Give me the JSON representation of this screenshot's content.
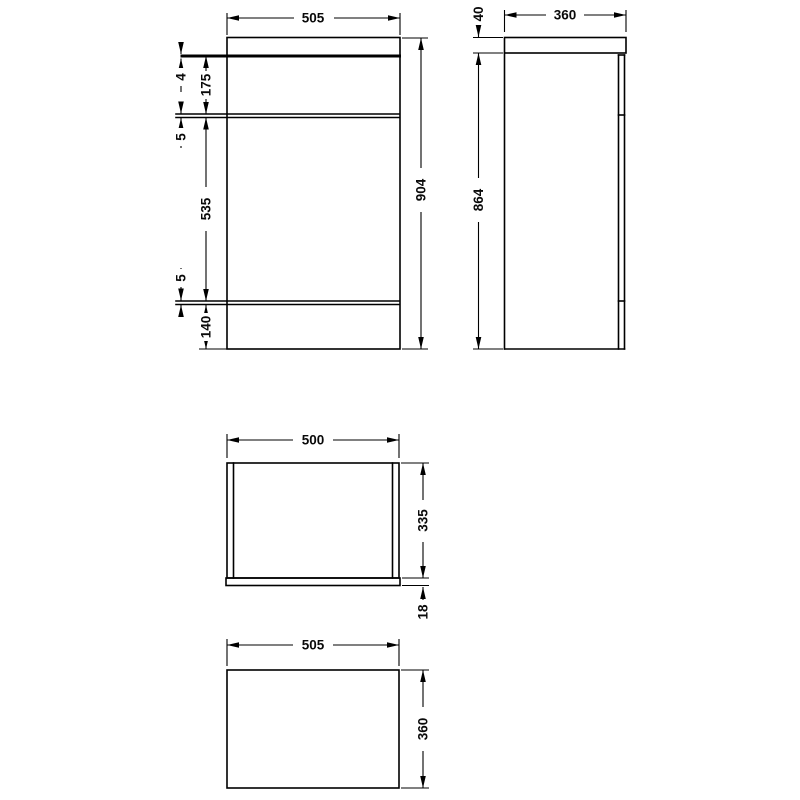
{
  "drawing": {
    "description": "Dimensioned orthographic technical drawing of a bathroom WC furniture unit: front view, side view, carcass plan view and worktop plan view",
    "units_shown": "mm",
    "colors": {
      "line": "#000000",
      "text": "#0a0a0a",
      "background": "#ffffff"
    },
    "views": {
      "front": {
        "width": "505",
        "overall_height": "904",
        "worktop_lip": "4",
        "upper_panel": "175",
        "upper_gap": "5",
        "door_panel": "535",
        "lower_gap": "5",
        "plinth": "140"
      },
      "side": {
        "depth": "360",
        "worktop_thickness": "40",
        "cabinet_height": "864"
      },
      "carcass_plan": {
        "width": "500",
        "depth": "335",
        "front_panel": "18"
      },
      "worktop_plan": {
        "width": "505",
        "depth": "360"
      }
    }
  }
}
